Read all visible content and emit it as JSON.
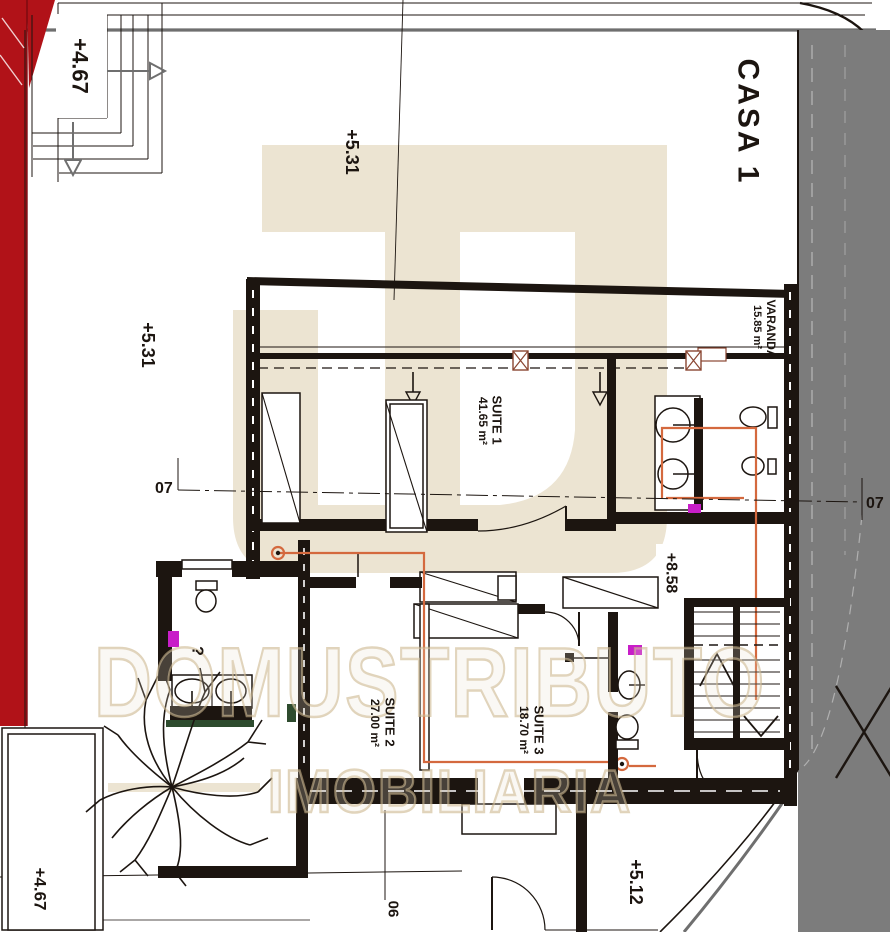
{
  "title": "CASA 1",
  "elevations": {
    "top_left": "+4.67",
    "top_center": "+5.31",
    "mid_left": "+5.31",
    "hall": "+8.58",
    "bottom_left": "+4.67",
    "bottom_right": "+5.12"
  },
  "rooms": {
    "varanda": {
      "name": "VARANDA",
      "area": "15.85 m²"
    },
    "suite1": {
      "name": "SUITE 1",
      "area": "41.65 m²"
    },
    "suite2": {
      "name": "SUITE 2",
      "area": "27.00 m²"
    },
    "suite3": {
      "name": "SUITE 3",
      "area": "18.70 m²"
    }
  },
  "sections": {
    "left": "07",
    "right": "07",
    "bottom": "06"
  },
  "notes": {
    "question_mark": "?"
  },
  "watermark": {
    "brand": "DOMUSTRIBUTO",
    "subtitle": "IMOBILIARIA"
  },
  "colors": {
    "line": "#1c1510",
    "red": "#b11218",
    "gray_band": "#7c7c7c",
    "gray_line": "#6f6f6f",
    "beige": "#ece4d2",
    "orange": "#d4693e",
    "cyan": "#3fd9df",
    "magenta": "#c81ec8",
    "green": "#2e4b2e",
    "column": "#8a4632",
    "wm_stroke": "#cbb68c"
  }
}
